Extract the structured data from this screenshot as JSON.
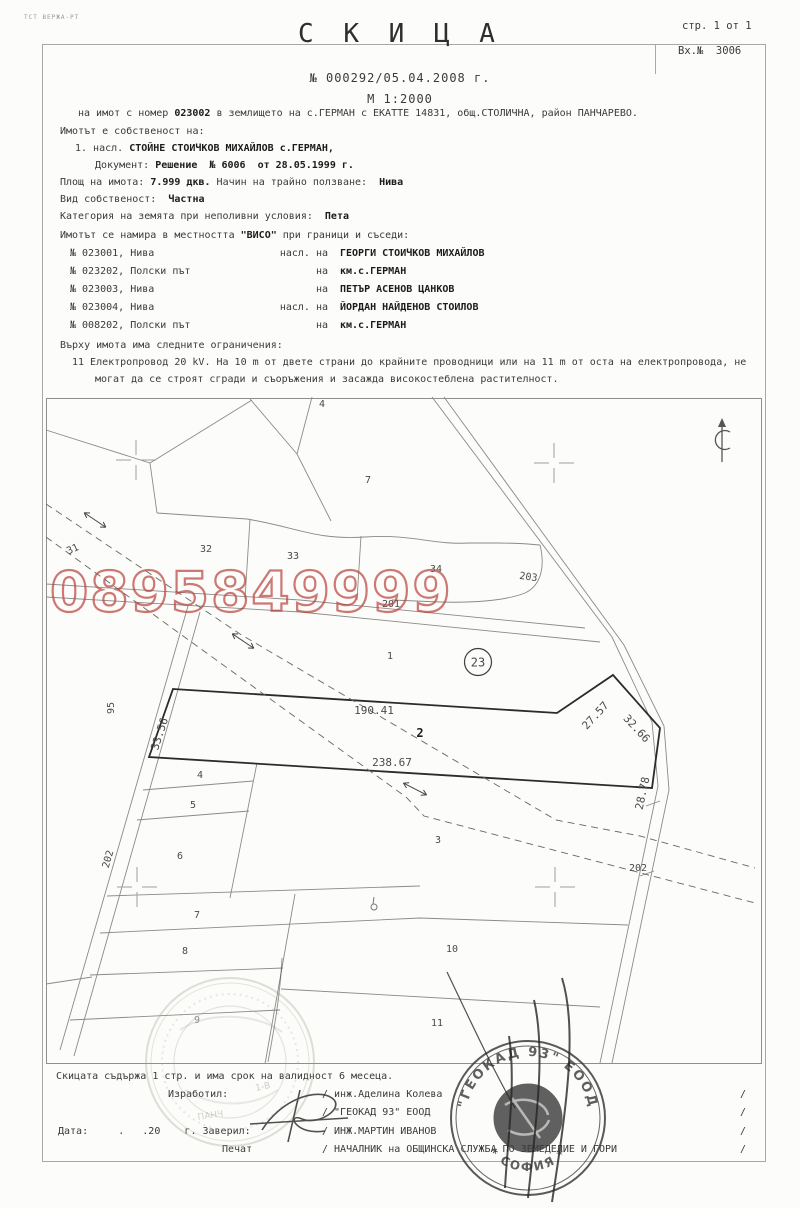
{
  "page": {
    "corner_mark": "ТСТ ВЕРЖА-РТ",
    "page_info": "стр. 1 от 1",
    "entry_no": "Вх.№  3006"
  },
  "header": {
    "title": "С К И Ц А",
    "number_line": "№ 000292/05.04.2008 г.",
    "scale_line": "М 1:2000",
    "subject_pre": "на имот с номер ",
    "subject_num": "023002",
    "subject_post": " в землището на с.ГЕРМАН с ЕКАТТЕ 14831, общ.СТОЛИЧНА, район ПАНЧАРЕВО."
  },
  "ownership": {
    "intro": "Имотът е собственост на:",
    "owner_prefix": "1. насл. ",
    "owner_name": "СТОЙНЕ СТОИЧКОВ МИХАЙЛОВ с.ГЕРМАН,",
    "doc_label": "Документ: ",
    "doc_value": "Решение  № 6006  от 28.05.1999 г.",
    "area_label": "Площ на имота: ",
    "area_value": "7.999 дкв.",
    "usage_label": " Начин на трайно ползване:  ",
    "usage_value": "Нива",
    "kind_label": "Вид собственост:  ",
    "kind_value": "Частна",
    "category_label": "Категория на земята при неполивни условия:  ",
    "category_value": "Пета"
  },
  "neighbors": {
    "intro_pre": "Имотът се намира в местността ",
    "intro_place": "\"ВИСО\"",
    "intro_post": " при граници и съседи:",
    "rows": [
      {
        "id": "№ 023001, Нива",
        "rel": "насл. на",
        "name": "ГЕОРГИ СТОИЧКОВ МИХАЙЛОВ"
      },
      {
        "id": "№ 023202, Полски път",
        "rel": "на",
        "name": "км.с.ГЕРМАН"
      },
      {
        "id": "№ 023003, Нива",
        "rel": "на",
        "name": "ПЕТЪР АСЕНОВ ЦАНКОВ"
      },
      {
        "id": "№ 023004, Нива",
        "rel": "насл. на",
        "name": "ЙОРДАН НАЙДЕНОВ СТОИЛОВ"
      },
      {
        "id": "№ 008202, Полски път",
        "rel": "на",
        "name": "км.с.ГЕРМАН"
      }
    ]
  },
  "restrictions": {
    "intro": "Върху имота има следните ограничения:",
    "lines": [
      "11 Електропровод 20 kV. На 10 m от двете страни до крайните проводници или на 11 m от оста на електропровода, не",
      "могат да се строят сгради и съоръжения и засажда високостеблена растителност."
    ]
  },
  "map": {
    "circled_parcel": "23",
    "watermark": {
      "text": "0895849999",
      "color": "#bb4b44"
    },
    "labels": [
      {
        "t": "4",
        "x": 322,
        "y": 407
      },
      {
        "t": "7",
        "x": 368,
        "y": 483
      },
      {
        "t": "31",
        "x": 74,
        "y": 552,
        "r": -25
      },
      {
        "t": "32",
        "x": 206,
        "y": 552
      },
      {
        "t": "33",
        "x": 293,
        "y": 559
      },
      {
        "t": "34",
        "x": 436,
        "y": 572
      },
      {
        "t": "203",
        "x": 528,
        "y": 580,
        "r": 8
      },
      {
        "t": "201",
        "x": 391,
        "y": 607
      },
      {
        "t": "1",
        "x": 390,
        "y": 659
      },
      {
        "t": "95",
        "x": 114,
        "y": 708,
        "r": -90
      },
      {
        "t": "33.56",
        "x": 163,
        "y": 735,
        "r": -72,
        "s": 11
      },
      {
        "t": "190.41",
        "x": 374,
        "y": 714,
        "s": 11
      },
      {
        "t": "2",
        "x": 420,
        "y": 737,
        "b": true,
        "s": 12
      },
      {
        "t": "238.67",
        "x": 392,
        "y": 766,
        "s": 11
      },
      {
        "t": "27.57",
        "x": 598,
        "y": 718,
        "r": -47,
        "s": 11
      },
      {
        "t": "32.66",
        "x": 634,
        "y": 731,
        "r": 47,
        "s": 11
      },
      {
        "t": "28.78",
        "x": 646,
        "y": 794,
        "r": -78,
        "s": 11
      },
      {
        "t": "4",
        "x": 200,
        "y": 778
      },
      {
        "t": "5",
        "x": 193,
        "y": 808
      },
      {
        "t": "6",
        "x": 180,
        "y": 859
      },
      {
        "t": "202",
        "x": 111,
        "y": 860,
        "r": -74
      },
      {
        "t": "3",
        "x": 438,
        "y": 843
      },
      {
        "t": "7",
        "x": 197,
        "y": 918
      },
      {
        "t": "8",
        "x": 185,
        "y": 954
      },
      {
        "t": "10",
        "x": 452,
        "y": 952
      },
      {
        "t": "202",
        "x": 638,
        "y": 871
      },
      {
        "t": "9",
        "x": 197,
        "y": 1023,
        "f": true
      },
      {
        "t": "11",
        "x": 437,
        "y": 1026
      }
    ],
    "stamp_dark": {
      "text_top": "\"ГЕОКАД 93\" ЕООД",
      "text_bottom": "* СОФИЯ *"
    },
    "stamp_faint": {
      "frag1": "1-В",
      "frag2": "ПАНЧ"
    }
  },
  "footer": {
    "validity": "Скицата съдържа 1 стр. и има срок на валидност 6 месеца.",
    "made_by_label": "Изработил:",
    "date_label": "Дата:     .   .20    г. Заверил:",
    "seal_label": "Печат",
    "names": [
      "/ инж.Аделина Колева",
      "/ \"ГЕОКАД 93\" ЕООД",
      "/ ИНЖ.МАРТИН ИВАНОВ",
      "/ НАЧАЛНИК на ОБЩИНСКА СЛУЖБА ПО ЗЕМЕДЕЛИЕ И ГОРИ"
    ],
    "slash": "/"
  }
}
